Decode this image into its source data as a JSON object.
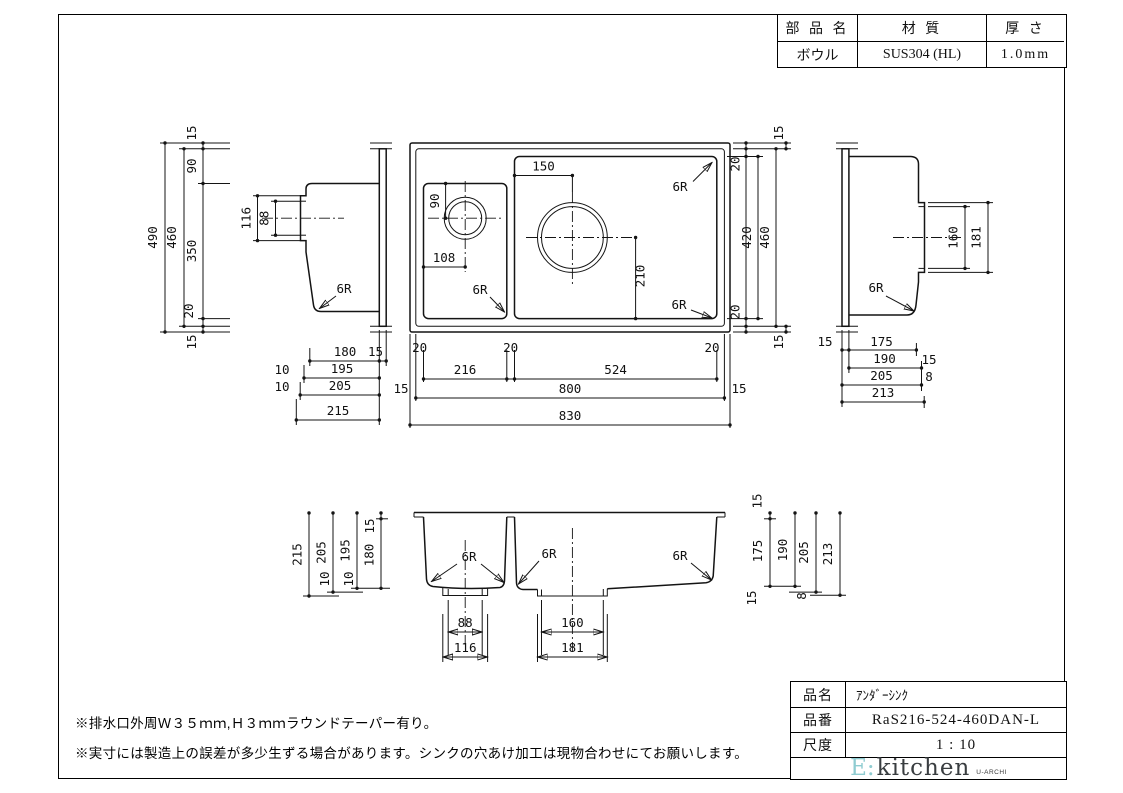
{
  "spec_table": {
    "headers": [
      "部 品 名",
      "材 質",
      "厚 さ"
    ],
    "row": {
      "part": "ボウル",
      "material": "SUS304 (HL)",
      "thickness": "1.0mm"
    }
  },
  "title_block": {
    "rows": [
      {
        "label": "品名",
        "value": "ｱﾝﾀﾞｰｼﾝｸ"
      },
      {
        "label": "品番",
        "value": "RaS216-524-460DAN-L"
      },
      {
        "label": "尺度",
        "value": "1 : 10"
      }
    ],
    "logo": {
      "prefix": "E:",
      "name": "kitchen",
      "sub": "U-ARCHI"
    }
  },
  "notes": [
    "※排水口外周Ｗ３５ｍｍ,Ｈ３ｍｍラウンドテーパー有り。",
    "※実寸には製造上の誤差が多少生ずる場合があります。シンクの穴あけ加工は現物合わせにてお願いします。"
  ],
  "dims": {
    "d8": "8",
    "d10": "10",
    "d15": "15",
    "d20": "20",
    "d88": "88",
    "d90": "90",
    "d108": "108",
    "d116": "116",
    "d150": "150",
    "d160": "160",
    "d175": "175",
    "d180": "180",
    "d181": "181",
    "d190": "190",
    "d195": "195",
    "d205": "205",
    "d210": "210",
    "d213": "213",
    "d215": "215",
    "d216": "216",
    "d350": "350",
    "d420": "420",
    "d460": "460",
    "d490": "490",
    "d524": "524",
    "d800": "800",
    "d830": "830",
    "r6": "6R"
  },
  "colors": {
    "accent_logo": "#8fccd1",
    "ink": "#141414"
  }
}
